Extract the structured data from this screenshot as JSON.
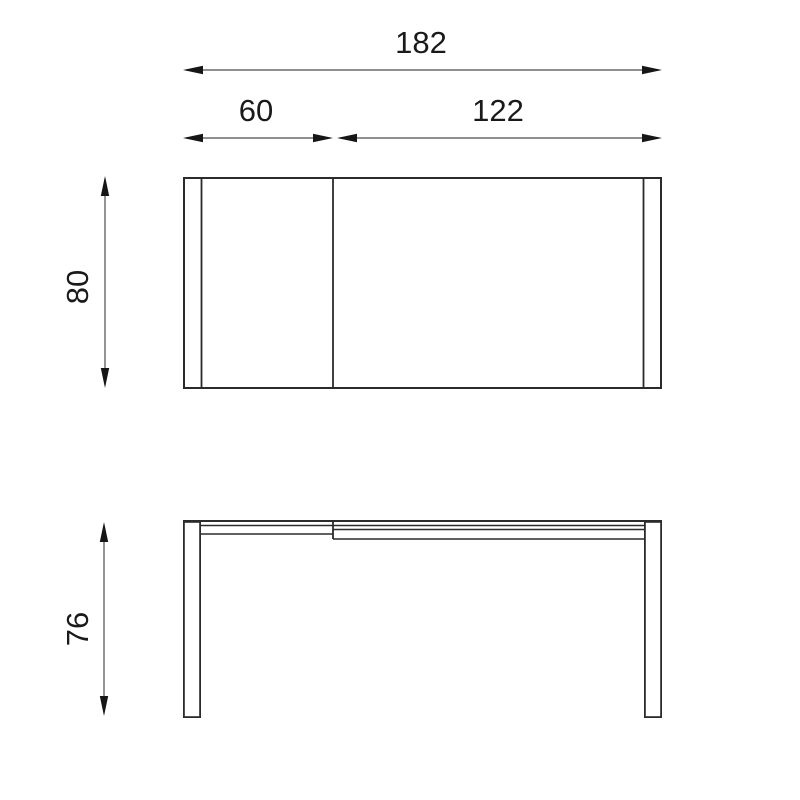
{
  "drawing": {
    "type": "furniture-technical-drawing",
    "subject": "extendable table — top view and front view with dimensions",
    "labels": {
      "total_width": "182",
      "extension_width": "60",
      "main_width": "122",
      "depth": "80",
      "height": "76"
    },
    "colors": {
      "background": "#ffffff",
      "object_line": "#2b2b2b",
      "dimension_line": "#4d4d4d",
      "arrowhead": "#161616",
      "text": "#1a1a1a"
    }
  }
}
